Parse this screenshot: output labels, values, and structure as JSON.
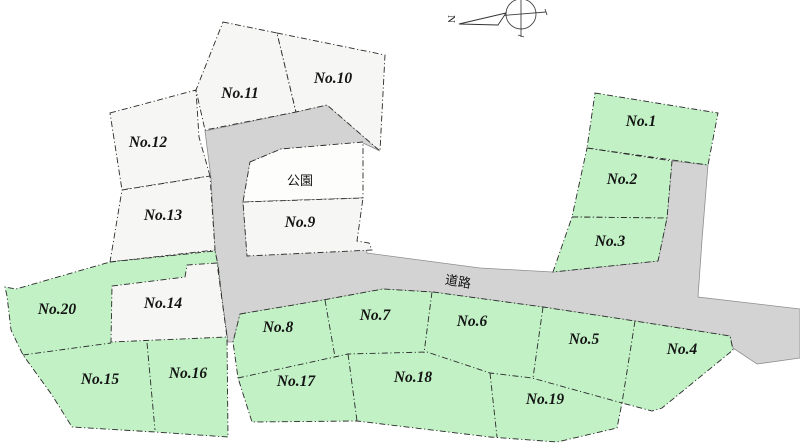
{
  "colors": {
    "green": "#c1f1c5",
    "white_plot": "#f6f6f4",
    "park": "#fdfdfc",
    "road": "#d3d3d3"
  },
  "plots": [
    {
      "label": "No.1",
      "fill": "green"
    },
    {
      "label": "No.2",
      "fill": "green"
    },
    {
      "label": "No.3",
      "fill": "green"
    },
    {
      "label": "No.4",
      "fill": "green"
    },
    {
      "label": "No.5",
      "fill": "green"
    },
    {
      "label": "No.6",
      "fill": "green"
    },
    {
      "label": "No.7",
      "fill": "green"
    },
    {
      "label": "No.8",
      "fill": "green"
    },
    {
      "label": "No.9",
      "fill": "white"
    },
    {
      "label": "No.10",
      "fill": "white"
    },
    {
      "label": "No.11",
      "fill": "white"
    },
    {
      "label": "No.12",
      "fill": "white"
    },
    {
      "label": "No.13",
      "fill": "white"
    },
    {
      "label": "No.14",
      "fill": "white"
    },
    {
      "label": "No.15",
      "fill": "green"
    },
    {
      "label": "No.16",
      "fill": "green"
    },
    {
      "label": "No.17",
      "fill": "green"
    },
    {
      "label": "No.18",
      "fill": "green"
    },
    {
      "label": "No.19",
      "fill": "green"
    },
    {
      "label": "No.20",
      "fill": "green"
    }
  ],
  "park": {
    "label": "公園"
  },
  "road": {
    "label": "道路"
  },
  "compass": {
    "label": "N"
  }
}
